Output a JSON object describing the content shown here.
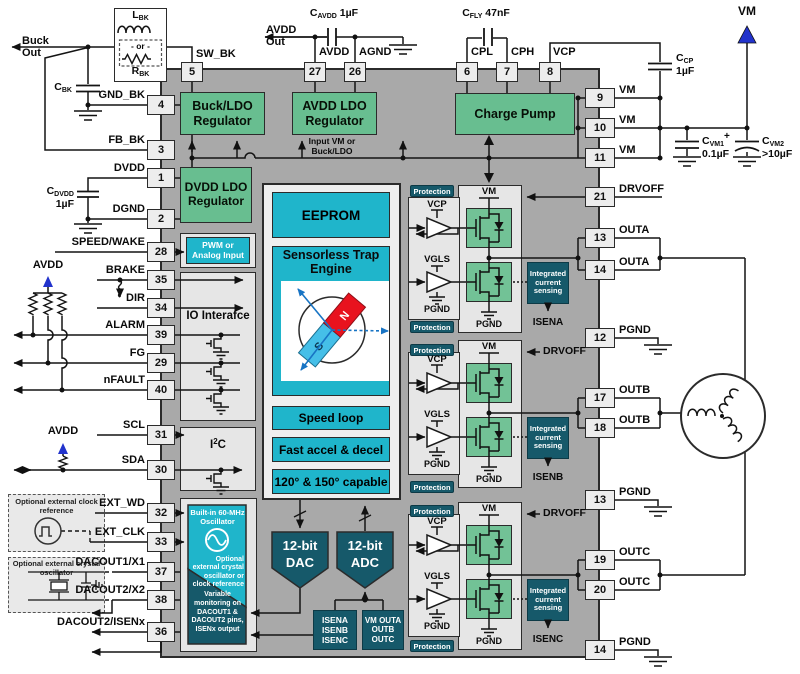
{
  "colors": {
    "green": "#68BE90",
    "cyan": "#1FB5CB",
    "teal": "#16596A",
    "body_gray": "#A9A9A9",
    "panel": "#E6E6E6",
    "fet_green": "#72C296",
    "blue": "#2233CC",
    "magnet_blue": "#45BFE8",
    "magnet_red": "#E8121E",
    "trap_arrow": "#1874C4"
  },
  "pins": {
    "top": [
      {
        "n": "5",
        "l": "SW_BK"
      },
      {
        "n": "27",
        "l": "AVDD"
      },
      {
        "n": "26",
        "l": "AGND"
      },
      {
        "n": "6",
        "l": "CPL"
      },
      {
        "n": "7",
        "l": "CPH"
      },
      {
        "n": "8",
        "l": "VCP"
      }
    ],
    "left": [
      {
        "n": "4",
        "l": "GND_BK"
      },
      {
        "n": "3",
        "l": "FB_BK"
      },
      {
        "n": "1",
        "l": "DVDD"
      },
      {
        "n": "2",
        "l": "DGND"
      },
      {
        "n": "28",
        "l": "SPEED/WAKE"
      },
      {
        "n": "35",
        "l": "BRAKE"
      },
      {
        "n": "34",
        "l": "DIR"
      },
      {
        "n": "39",
        "l": "ALARM"
      },
      {
        "n": "29",
        "l": "FG"
      },
      {
        "n": "40",
        "l": "nFAULT"
      },
      {
        "n": "31",
        "l": "SCL"
      },
      {
        "n": "30",
        "l": "SDA"
      },
      {
        "n": "32",
        "l": "EXT_WD"
      },
      {
        "n": "33",
        "l": "EXT_CLK"
      },
      {
        "n": "37",
        "l": "DACOUT1/X1"
      },
      {
        "n": "38",
        "l": "DACOUT2/X2"
      },
      {
        "n": "36",
        "l": "DACOUT2/ISENx"
      }
    ],
    "right": [
      {
        "n": "9",
        "l": "VM"
      },
      {
        "n": "10",
        "l": "VM"
      },
      {
        "n": "11",
        "l": "VM"
      },
      {
        "n": "21",
        "l": "DRVOFF"
      },
      {
        "n": "13",
        "l": "OUTA"
      },
      {
        "n": "14",
        "l": "OUTA"
      },
      {
        "n": "12",
        "l": "PGND"
      },
      {
        "n": "17",
        "l": "OUTB"
      },
      {
        "n": "18",
        "l": "OUTB"
      },
      {
        "n": "13",
        "l": "PGND"
      },
      {
        "n": "19",
        "l": "OUTC"
      },
      {
        "n": "20",
        "l": "OUTC"
      },
      {
        "n": "14",
        "l": "PGND"
      }
    ]
  },
  "blocks": {
    "buck_ldo": "Buck/LDO Regulator",
    "avdd_ldo": "AVDD LDO Regulator",
    "charge_pump": "Charge Pump",
    "dvdd_ldo": "DVDD LDO Regulator",
    "input_vm": "Input VM or Buck/LDO",
    "pwm": "PWM or Analog Input",
    "io": "IO Interafce",
    "i2c_b": "I",
    "i2c_sup": "2",
    "i2c_x": "C",
    "eeprom": "EEPROM",
    "trap": "Sensorless Trap Engine",
    "speed": "Speed loop",
    "accel": "Fast accel & decel",
    "capable": "120° & 150° capable",
    "dac": "12-bit DAC",
    "adc": "12-bit ADC",
    "isen_list": "ISENA ISENB ISENC",
    "vm_list": "VM OUTA OUTB OUTC",
    "osc_top": "Built-in 60-MHz Oscillator",
    "osc_mid": "Optional external crystal oscillator or clock reference",
    "osc_bot": "Variable monitoring on DACOUT1 & DACOUT2 pins, ISENx output"
  },
  "driver": {
    "vm": "VM",
    "vcp": "VCP",
    "vgls": "VGLS",
    "pgnd": "PGND",
    "protection": "Protection",
    "ics": "Integrated current sensing",
    "drvoff": "DRVOFF",
    "isena": "ISENA",
    "isenb": "ISENB",
    "isenc": "ISENC"
  },
  "buckparts": {
    "out1": "Buck",
    "out2": "Out",
    "lbk_b": "L",
    "lbk_s": "BK",
    "or": "- or -",
    "rbk_b": "R",
    "rbk_s": "BK",
    "cbk_b": "C",
    "cbk_s": "BK"
  },
  "caps": {
    "cdvdd_b": "C",
    "cdvdd_s": "DVDD",
    "cdvdd_v": "1µF",
    "cavdd_b": "C",
    "cavdd_s": "AVDD",
    "cavdd_v": " 1µF",
    "cfly_b": "C",
    "cfly_s": "FLY",
    "cfly_v": " 47nF",
    "ccp_b": "C",
    "ccp_s": "CP",
    "ccp_v": "1µF",
    "cvm1_b": "C",
    "cvm1_s": "VM1",
    "cvm1_v": "0.1µF",
    "cvm2_b": "C",
    "cvm2_s": "VM2",
    "cvm2_v": ">10µF",
    "plus": "+"
  },
  "supplies": {
    "vm": "VM",
    "avdd": "AVDD",
    "avdd2": "AVDD",
    "avdd_out1": "AVDD",
    "avdd_out2": "Out"
  },
  "externals": {
    "clock_ref": "Optional external clock reference",
    "crystal": "Optional external crystal oscillator"
  },
  "motor": {
    "s": "S",
    "n": "N"
  }
}
